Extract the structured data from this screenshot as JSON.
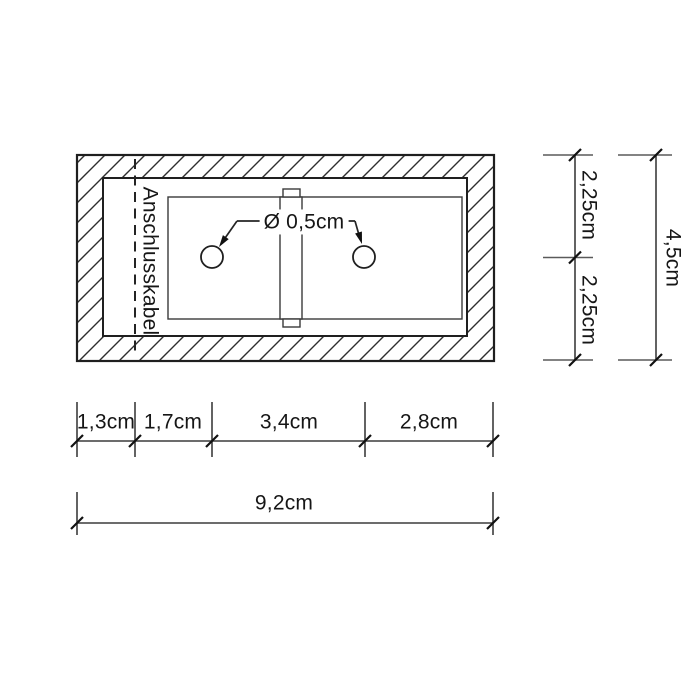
{
  "diagram": {
    "cable_label": "Anschlusskabel",
    "hole_diameter_label": "Ø 0,5cm",
    "vertical_dims": {
      "upper": "2,25cm",
      "lower": "2,25cm",
      "total": "4,5cm"
    },
    "horizontal_dims": {
      "segments": [
        "1,3cm",
        "1,7cm",
        "3,4cm",
        "2,8cm"
      ],
      "total": "9,2cm"
    },
    "colors": {
      "background": "#ffffff",
      "drawing_line": "#1f1f1f",
      "dimension_line": "#3c3c3c",
      "extension_line": "#5a5a5a",
      "hatch_line": "#2e2e2e"
    }
  }
}
